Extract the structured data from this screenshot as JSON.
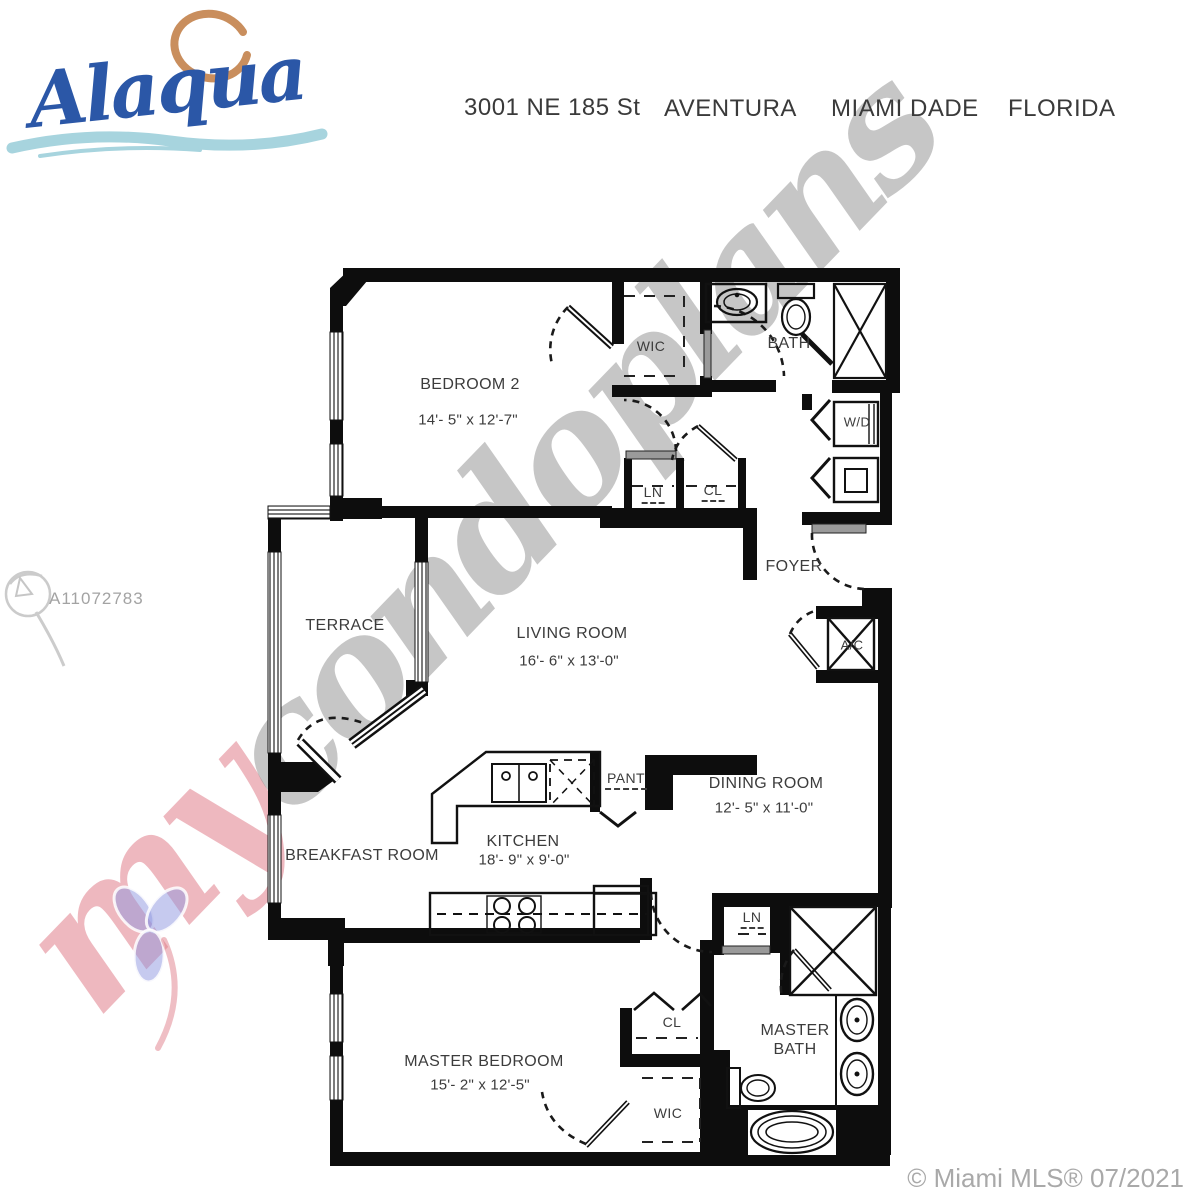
{
  "header": {
    "logo_text": "Alaqua",
    "address": "3001 NE 185 St",
    "city": "AVENTURA",
    "county": "MIAMI DADE",
    "state": "FLORIDA"
  },
  "labels": {
    "bedroom2": {
      "name": "BEDROOM 2",
      "dims": "14'- 5\" x 12'-7\""
    },
    "wic_top": {
      "name": "WIC"
    },
    "bath": {
      "name": "BATH"
    },
    "wd": {
      "name": "W/D"
    },
    "ln_top": {
      "name": "LN"
    },
    "cl_top": {
      "name": "CL"
    },
    "foyer": {
      "name": "FOYER"
    },
    "terrace": {
      "name": "TERRACE"
    },
    "living": {
      "name": "LIVING ROOM",
      "dims": "16'- 6\" x 13'-0\""
    },
    "ac": {
      "name": "A/C"
    },
    "dining": {
      "name": "DINING ROOM",
      "dims": "12'- 5\" x 11'-0\""
    },
    "pant": {
      "name": "PANT"
    },
    "kitchen": {
      "name": "KITCHEN",
      "dims": "18'- 9\" x 9'-0\""
    },
    "breakfast": {
      "name": "BREAKFAST ROOM"
    },
    "master": {
      "name": "MASTER BEDROOM",
      "dims": "15'- 2\" x 12'-5\""
    },
    "cl_master": {
      "name": "CL"
    },
    "wic_master": {
      "name": "WIC"
    },
    "ln_master": {
      "name": "LN"
    },
    "master_bath": {
      "name": "MASTER BATH"
    }
  },
  "watermark": {
    "prefix": "my",
    "suffix": "condoplans",
    "mls_id": "A11072783",
    "copyright": "© Miami MLS® 07/2021"
  },
  "colors": {
    "logo_blue": "#2b57a7",
    "logo_orange": "#c98e5d",
    "logo_wave": "#a7d4de",
    "wall_black": "#0d0d0d",
    "label_gray": "#3c3c3c",
    "watermark_gray": "#8e8e8e",
    "watermark_pink": "#e07e8a",
    "mls_gray": "#a3a3a3"
  }
}
